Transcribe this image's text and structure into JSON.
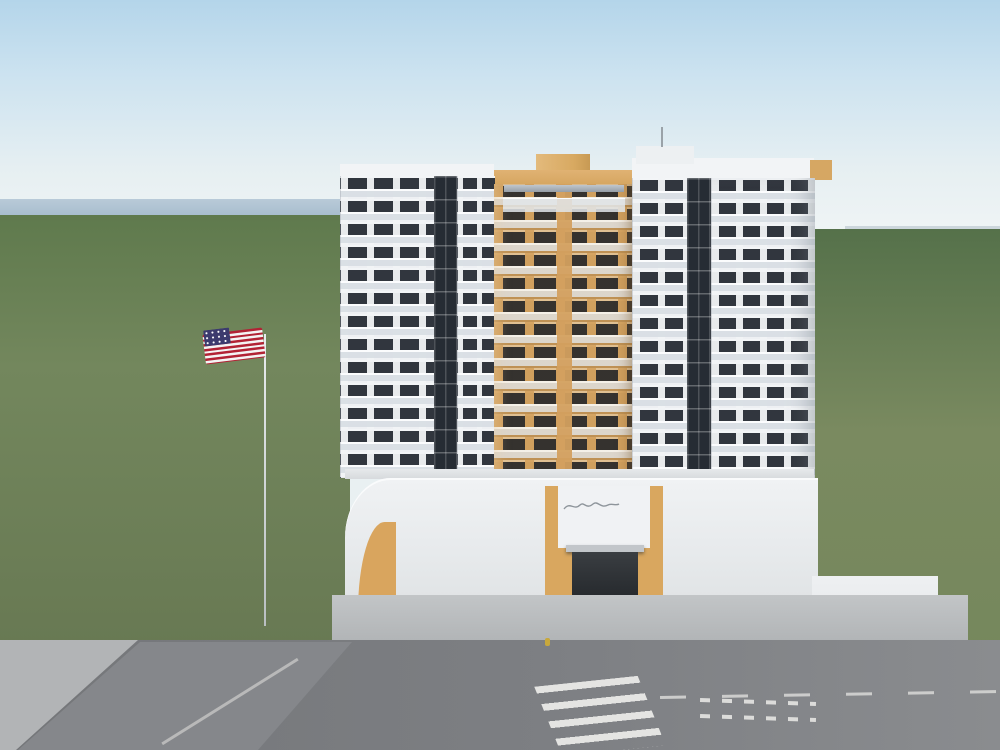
{
  "annotation": {
    "line1": "Brickel Vista",
    "line2": "PH 1606",
    "text_color": "#d7261c",
    "arrow_color": "#e0311c",
    "box_color": "#e8330f"
  },
  "building": {
    "address": "900",
    "facade_white": "#eef0f3",
    "facade_tan": "#d5a360",
    "glass_dark": "#262c34",
    "railing": "#ccd2d8",
    "podium_panel": "#8b99a6"
  },
  "scene_colors": {
    "sky_top": "#b4d5ea",
    "sky_horizon": "#f6f8f6",
    "water": "#a9bfd0",
    "tree_dark": "#2f4d28",
    "tree_light": "#6b8a46",
    "grass": "#7fa24f",
    "road": "#7a7c80",
    "sidewalk": "#b7babc",
    "roof_terracotta": "#a2593f",
    "strip_mall_tan": "#dcc9a0",
    "orange_building": "#e59a77",
    "flag_red": "#b22234",
    "flag_blue": "#3c3b6e"
  }
}
